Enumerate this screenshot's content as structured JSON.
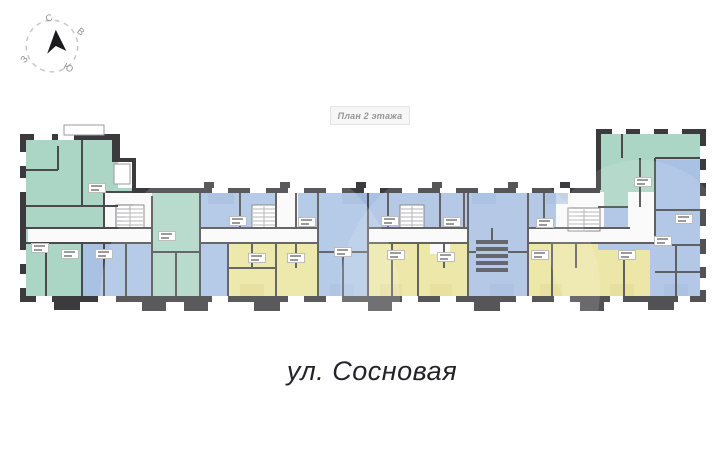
{
  "compass": {
    "directions": {
      "north": "С",
      "east": "В",
      "south": "Ю",
      "west": "З"
    }
  },
  "plan_header": {
    "label": "План 2 этажа"
  },
  "street": {
    "label": "ул. Сосновая"
  },
  "colors": {
    "green": "#abd5c5",
    "blue": "#a9c1e3",
    "yellow": "#eae49c",
    "blue-dark": "#96b1d6",
    "yellow-dark": "#ddd689",
    "wall": "#3b3b3e",
    "wall-light": "#4a4a4d",
    "corridor": "#fafafa",
    "hatch": "#aaaaad",
    "tag-border": "#bdbdbd",
    "tag-text": "#8a8a8a",
    "label-bg": "#f6f6f6",
    "label-border": "#e4e4e4",
    "label-text": "#969696",
    "compass-line": "#c6c6c6",
    "compass-text": "#8f8f8f",
    "arrow": "#1b1b1d",
    "street-text": "#23232b"
  },
  "plan": {
    "unit_tags": [
      {
        "x": 97,
        "y": 188
      },
      {
        "x": 40,
        "y": 248
      },
      {
        "x": 70,
        "y": 254
      },
      {
        "x": 104,
        "y": 254
      },
      {
        "x": 167,
        "y": 236
      },
      {
        "x": 238,
        "y": 221
      },
      {
        "x": 307,
        "y": 222
      },
      {
        "x": 343,
        "y": 252
      },
      {
        "x": 257,
        "y": 258
      },
      {
        "x": 296,
        "y": 258
      },
      {
        "x": 390,
        "y": 221
      },
      {
        "x": 452,
        "y": 222
      },
      {
        "x": 396,
        "y": 255
      },
      {
        "x": 446,
        "y": 257
      },
      {
        "x": 545,
        "y": 223
      },
      {
        "x": 540,
        "y": 255
      },
      {
        "x": 627,
        "y": 255
      },
      {
        "x": 643,
        "y": 182
      },
      {
        "x": 684,
        "y": 219
      },
      {
        "x": 663,
        "y": 241
      }
    ]
  }
}
